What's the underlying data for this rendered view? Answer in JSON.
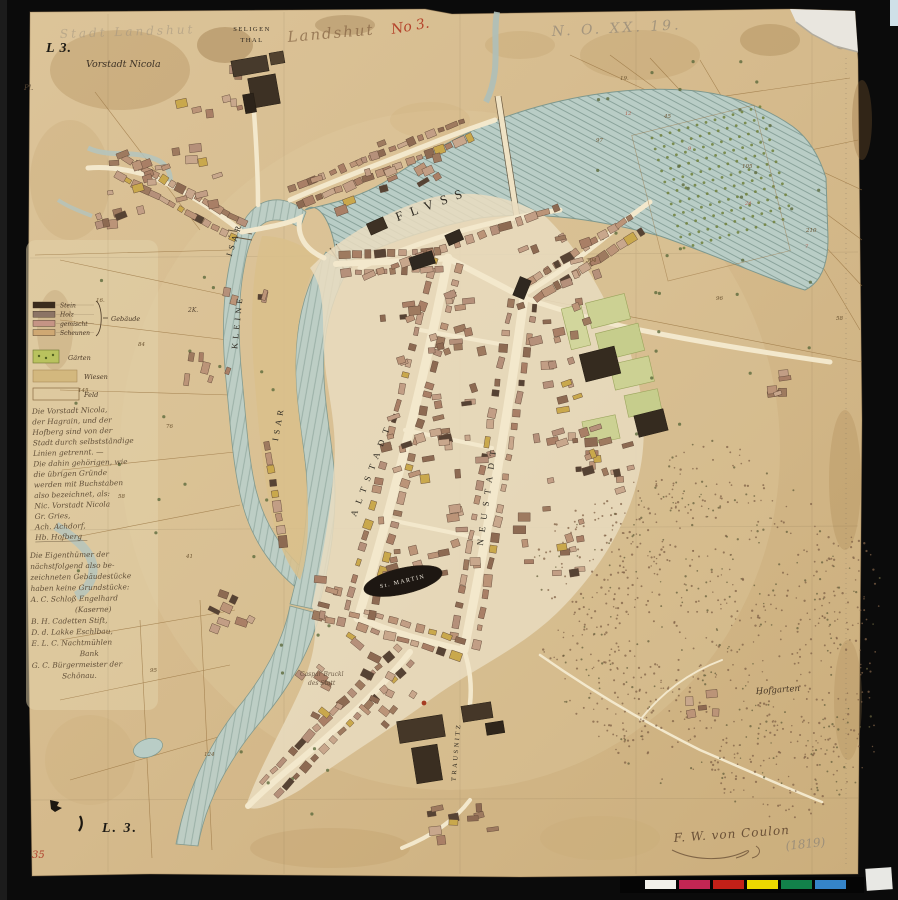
{
  "meta": {
    "title": "Plan der Stadt Landshut — historische Handzeichnung"
  },
  "frame": {
    "background": "#0b0b0b",
    "paper": "#d7bd92"
  },
  "annotations": {
    "corner_label_top": "L 3.",
    "corner_label_bottom": "L. 3.",
    "red_sheet_number": "35",
    "pencil_top_left": "Stadt Landshut",
    "ink_title": "Landshut",
    "red_number": "No 3.",
    "pencil_top_right": "N. O. XX. 19.",
    "pencil_flourish": "9",
    "pl_mark": "Pl.",
    "signature": "F. W. von Coulon",
    "year": "(1819)"
  },
  "places": {
    "vorstadt_nicola": "Vorstadt Nicola",
    "seligenthal_line1": "SELIGEN",
    "seligenthal_line2": "THAL",
    "fluss": "FLVSS",
    "kleine": "KLEINE",
    "isar_upper": "ISAR",
    "isar_lower": "ISAR",
    "altstadt": "ALTSTADT",
    "neustadt": "NEUSTADT",
    "st_martin": "St. MARTIN",
    "trausnitz": "TRAUSNITZ",
    "hofgarten": "Hofgarten",
    "note_small_line1": "Caspar Bruckl",
    "note_small_line2": "des Statt",
    "island_plot": "2K."
  },
  "legend": {
    "group_label": "Gebäude",
    "rows": [
      {
        "color": "#3a2b1d",
        "label": "Stein"
      },
      {
        "color": "#8c7465",
        "label": "Holz"
      },
      {
        "color": "#c59485",
        "label": "gemischt"
      },
      {
        "color": "#cfa873",
        "label": "Scheunen"
      }
    ],
    "garden": {
      "color": "#b9c25e",
      "label": "Gärten"
    },
    "meadow": {
      "color": "#d3b87e",
      "label": "Wiesen"
    },
    "field": {
      "color": "none",
      "label": "Feld"
    }
  },
  "handwriting": {
    "block1": [
      "Die Vorstadt Nicola,",
      "der Hagrain, und der",
      "Hofberg sind von der",
      "Stadt durch selbstständige",
      "Linien getrennt. —",
      "Die dahin gehörigen, wie",
      "die übrigen Gründe",
      "werden mit Buchstaben",
      "also bezeichnet, als:",
      "Nic. Vorstadt Nicola",
      "Gr. Gries,",
      "Ach. Achdorf,",
      "Hb. Hofberg"
    ],
    "block2": [
      "Die Eigenthümer der",
      "nächstfolgend also be-",
      "zeichneten Gebäudestücke",
      "haben keine Grundstücke:",
      "A. C. Schloß Engelhard",
      {
        "t": "(Kaserne)",
        "dx": 44
      },
      "B. H. Cadetten Stift,",
      "D. d. Lakke Eschlbau,",
      "E. L. C. Nachtmühlen",
      {
        "t": "Bank",
        "dx": 48
      },
      "G. C. Bürgermeister der",
      {
        "t": "Schönau.",
        "dx": 30
      }
    ]
  },
  "field_numbers": [
    {
      "x": 96,
      "y": 302,
      "t": "16."
    },
    {
      "x": 138,
      "y": 346,
      "t": "84"
    },
    {
      "x": 78,
      "y": 392,
      "t": "145"
    },
    {
      "x": 166,
      "y": 428,
      "t": "76"
    },
    {
      "x": 118,
      "y": 498,
      "t": "58"
    },
    {
      "x": 186,
      "y": 558,
      "t": "41"
    },
    {
      "x": 150,
      "y": 672,
      "t": "95"
    },
    {
      "x": 204,
      "y": 756,
      "t": "124"
    },
    {
      "x": 596,
      "y": 142,
      "t": "97"
    },
    {
      "x": 664,
      "y": 118,
      "t": "45"
    },
    {
      "x": 742,
      "y": 168,
      "t": "105"
    },
    {
      "x": 806,
      "y": 232,
      "t": "210"
    },
    {
      "x": 620,
      "y": 80,
      "t": "19."
    },
    {
      "x": 586,
      "y": 262,
      "t": "304"
    },
    {
      "x": 716,
      "y": 300,
      "t": "96"
    },
    {
      "x": 836,
      "y": 320,
      "t": "58"
    }
  ],
  "red_numbers": [
    {
      "x": 625,
      "y": 115,
      "t": "12"
    },
    {
      "x": 688,
      "y": 150,
      "t": "9"
    },
    {
      "x": 745,
      "y": 205,
      "t": "24"
    },
    {
      "x": 805,
      "y": 248,
      "t": "7"
    }
  ],
  "color_bar": {
    "background": "#050505",
    "patches": [
      "#f2f0ea",
      "#c22653",
      "#c22018",
      "#ecd900",
      "#12814a",
      "#3584c8"
    ]
  }
}
